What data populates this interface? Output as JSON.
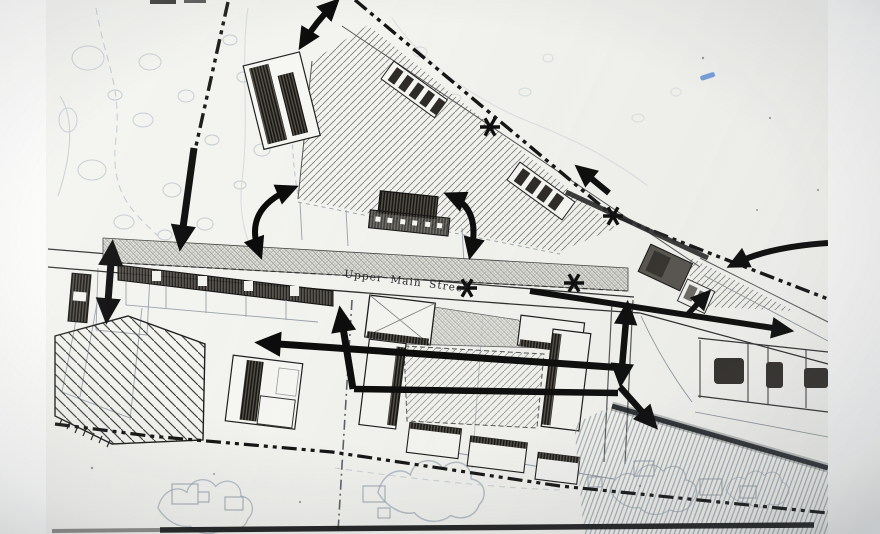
{
  "plan": {
    "street_label": "Upper Main Street"
  },
  "symbols": {
    "flow_arrow_icon": "bold-black-arrow",
    "junction_marker_icon": "✱",
    "junction_marker_count": 4,
    "boundary_line_style": "dash-dot"
  },
  "colors": {
    "paper": "#f3f3ef",
    "margin_white": "#fbfbf9",
    "ink": "#0c0c0c",
    "contour_blue": "#b7c2cb",
    "stray_blue_mark": "#5f8fd8"
  }
}
